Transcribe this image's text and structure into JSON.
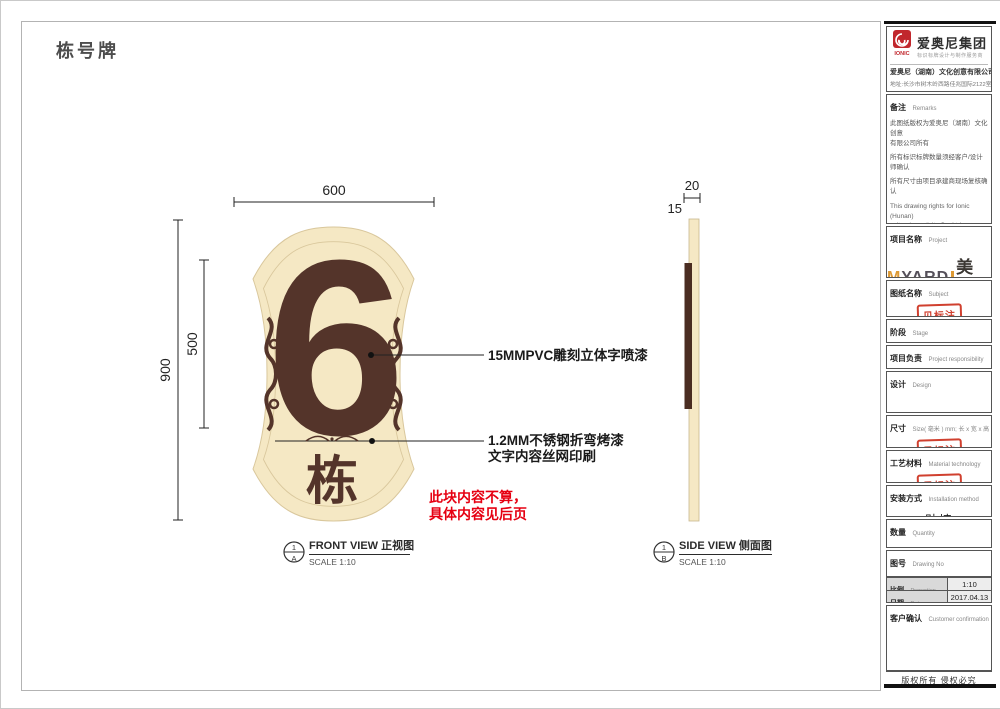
{
  "page": {
    "title": "栋号牌",
    "copyright": "版权所有  侵权必究"
  },
  "front_view": {
    "dim_width": "600",
    "dim_height": "900",
    "dim_inner": "500",
    "number": "6",
    "suffix": "栋",
    "callout_pvc": "15MMPVC雕刻立体字喷漆",
    "callout_steel_1": "1.2MM不锈钢折弯烤漆",
    "callout_steel_2": "文字内容丝网印刷",
    "note_1": "此块内容不算，",
    "note_2": "具体内容见后页",
    "ref_num": "1",
    "ref_letter": "A",
    "label": "FRONT VIEW 正视图",
    "scale": "SCALE 1:10"
  },
  "side_view": {
    "dim_thickness": "20",
    "dim_face": "15",
    "ref_num": "1",
    "ref_letter": "B",
    "label": "SIDE VIEW 侧面图",
    "scale": "SCALE 1:10"
  },
  "company": {
    "logo_text": "IONIC",
    "group_name": "爱奥尼集团",
    "tagline": "标识标牌设计与制作服务商",
    "name": "爱奥尼（湖南）文化创意有限公司",
    "address": "地址:长沙市树木岭西路佳兆国际2122室",
    "phone": "电话:0731-85074045",
    "website": "http://www.ionic.net.cn"
  },
  "remarks": {
    "label_zh": "备注",
    "label_en": "Remarks",
    "items": [
      "此图纸版权为爱奥尼（湖南）文化创意\n有限公司所有",
      "所有标识标牌数量须经客户/设计师确认",
      "所有尺寸由项目承建商现场复核确认",
      "This drawing rights for Ionic (Hunan)\ncultural creativity Co. Ltd.",
      "All signs must be approved by the\ncustomer / designer to confirm the\nnumber of",
      "All dimensions by the project\ncontractors on site review confirmed"
    ]
  },
  "titleblock": {
    "stamp": "见标注",
    "project": {
      "zh": "项目名称",
      "en": "Project",
      "brand_m": "M",
      "brand_yard": "YARD",
      "brand_cn": "美院"
    },
    "subject": {
      "zh": "图纸名称",
      "en": "Subject"
    },
    "stage": {
      "zh": "阶段",
      "en": "Stage"
    },
    "responsibility": {
      "zh": "项目负责",
      "en": "Project responsibility"
    },
    "design": {
      "zh": "设计",
      "en": "Design"
    },
    "size": {
      "zh": "尺寸",
      "en": "Size( 毫米 ) mm; 长 x 宽 x 高"
    },
    "material": {
      "zh": "工艺材料",
      "en": "Material technology"
    },
    "install": {
      "zh": "安装方式",
      "en": "Installation method",
      "value": "贴墙"
    },
    "quantity": {
      "zh": "数量",
      "en": "Quantity",
      "value": "20块"
    },
    "drawing_no": {
      "zh": "图号",
      "en": "Drawing No",
      "value": "N1"
    },
    "proportion": {
      "zh": "比例",
      "en": "Proportion",
      "value": "1:10"
    },
    "date": {
      "zh": "日期",
      "en": "Date",
      "value": "2017.04.13"
    },
    "customer": {
      "zh": "客户确认",
      "en": "Customer confirmation"
    }
  },
  "colors": {
    "cream": "#f5e8c4",
    "brown": "#54342a",
    "note_red": "#e60012",
    "stamp_red": "#d0402f",
    "logo_red": "#c1272d",
    "brand_orange": "#dd9933"
  }
}
